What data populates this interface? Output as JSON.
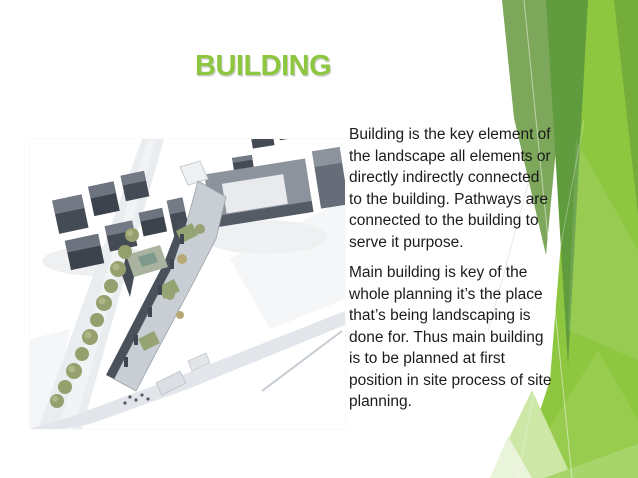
{
  "slide": {
    "title": "BUILDING",
    "body_paragraphs": [
      "Building is the key element of\nthe landscape all elements or\ndirectly indirectly connected\nto the building. Pathways are\nconnected to the building to\nserve it purpose.",
      "Main building is key of the\nwhole planning it’s the place\nthat’s being landscaping is\ndone for. Thus main building\nis to be planned at first\nposition in site process of site\nplanning."
    ],
    "image": {
      "alt": "Aerial architectural rendering of a building complex with surrounding dark buildings, a tree-lined street and roads"
    },
    "colors": {
      "background": "#ffffff",
      "title_green": "#8dc63f",
      "body_text": "#1b1b1b",
      "facet_bright_green": "#8dc63f",
      "facet_dark_green": "#609b3e",
      "facet_sage_green": "#7da75b",
      "facet_medium_green": "#74ad3a",
      "facet_pale_green": "#cde7a7",
      "rendering_dark_building": "#454b55",
      "rendering_light_building": "#c9ced4",
      "rendering_tree_green": "#96a06f"
    }
  }
}
